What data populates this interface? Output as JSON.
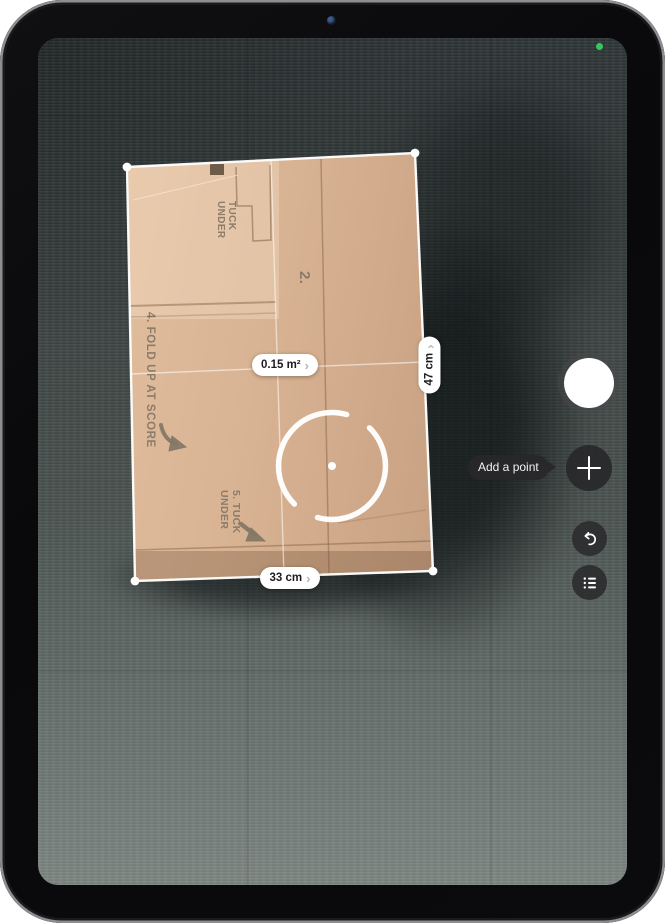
{
  "app": {
    "name": "Measure camera view"
  },
  "measurement": {
    "area": {
      "value": "0.15 m²"
    },
    "height": {
      "value": "47 cm"
    },
    "width": {
      "value": "33 cm"
    },
    "chevron": "›"
  },
  "tooltip": {
    "add_point": "Add a point"
  },
  "controls": {
    "shutter": {
      "label": "shutter"
    },
    "add_point": {
      "glyph": "+"
    },
    "undo": {
      "icon": "undo-arrow"
    },
    "list": {
      "icon": "measurement-list"
    }
  },
  "status": {
    "camera_in_use_indicator": "green-dot"
  },
  "box_print": {
    "panel_number": "2.",
    "tuck_slot": "TUCK\nUNDER",
    "fold_instruction": "4. FOLD UP AT SCORE",
    "tuck_instruction": "5. TUCK\nUNDER"
  },
  "colors": {
    "pill_bg": "#ffffff",
    "pill_text": "#1d1d1f",
    "chevron": "#b4b4ba",
    "control_bg": "rgba(40,40,42,0.92)",
    "camera_active_green": "#34c759",
    "box_tan": "#d9b494",
    "carpet": "#49524f",
    "measure_line": "#ffffff"
  }
}
